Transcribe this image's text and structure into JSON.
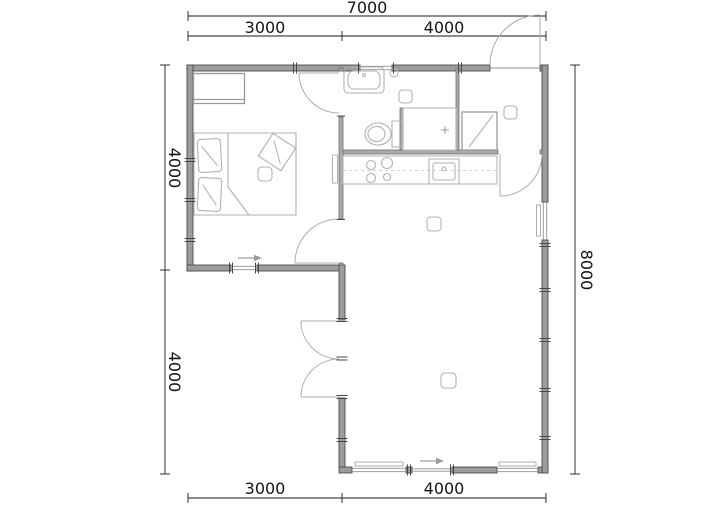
{
  "drawing": {
    "type": "architectural-floor-plan",
    "units": "mm",
    "dimensions": {
      "top_total": "7000",
      "top_left": "3000",
      "top_right": "4000",
      "left_upper": "4000",
      "left_lower": "4000",
      "right_total": "8000",
      "bottom_left": "3000",
      "bottom_right": "4000"
    },
    "icons": {
      "bed": "double-bed-icon",
      "wardrobe": "wardrobe-icon",
      "toilet": "toilet-icon",
      "washbasin": "washbasin-icon",
      "shower": "shower-icon",
      "stove": "stove-burners-icon",
      "sink": "kitchen-sink-icon",
      "drain": "floor-drain-icon",
      "entry_arrow": "entry-direction-arrow-icon"
    },
    "colors": {
      "background": "#ffffff",
      "exterior_wall": "#9c9c9c",
      "interior_wall": "#ababab",
      "wall_edge": "#4c4c4c",
      "furniture_line": "#b2b2b2",
      "dimension_text": "#141414"
    }
  }
}
